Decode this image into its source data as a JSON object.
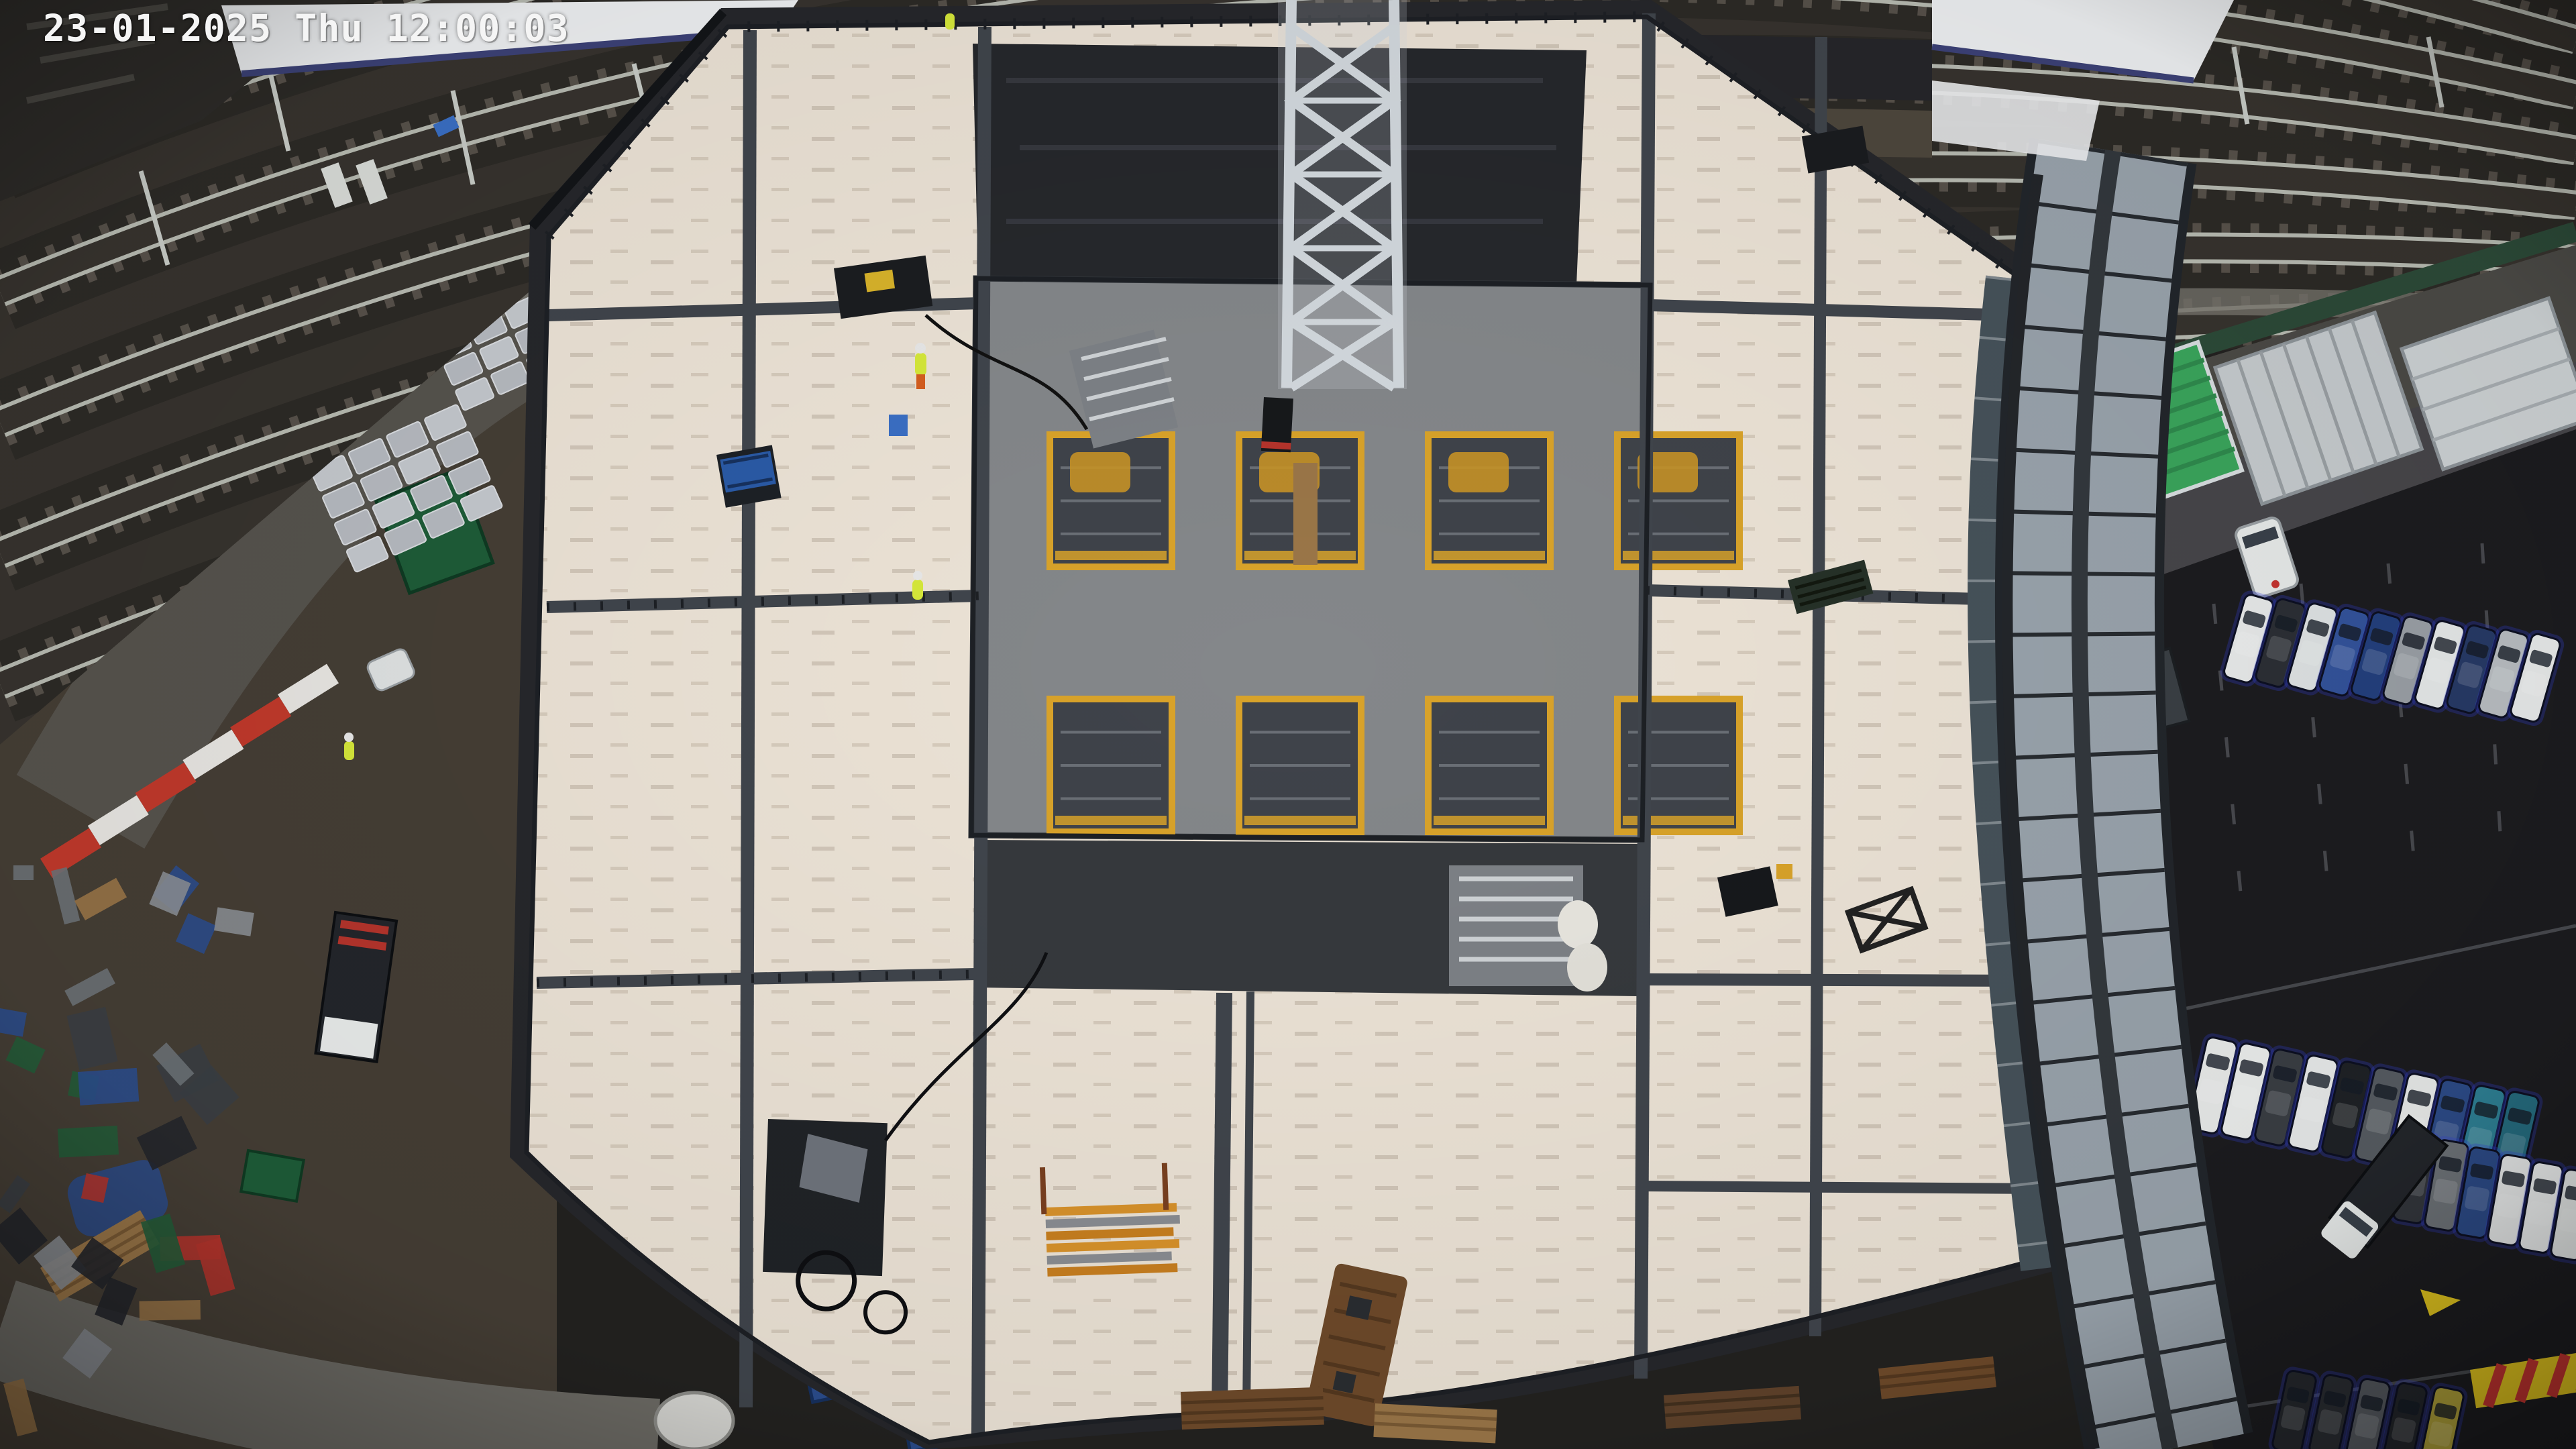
{
  "overlay": {
    "timestamp": "23-01-2025 Thu 12:00:03",
    "date": "23-01-2025",
    "day": "Thu",
    "time": "12:00:03"
  },
  "palette": {
    "osd_text": "#f5f5f5",
    "asphalt": "#232220",
    "ballast": "#37332e",
    "sleeper": "#57514a",
    "rail": "#b7bab1",
    "track_gap": "#2c2a26",
    "yard": "#453e35",
    "road": "#56534d",
    "path_light": "#6e6c66",
    "deck": "#ece3d6",
    "deck_shadow": "#d9cfc0",
    "steel": "#40454c",
    "mesh": "#1d2025",
    "scaffold_dark": "#26272b",
    "core": "#84878a",
    "core_void": "#3f434a",
    "formwork": "#d9a32a",
    "crane": "#d3d9de",
    "canopy": "#eef0f2",
    "canopy_edge": "#3c4277",
    "glazing": "#99a3ac",
    "glazing_frame": "#22262b",
    "fence_green": "#2c4a38",
    "grass": "#3c3b2c",
    "parking": "#1c1c1f",
    "container_green_roof": "#3aa55c",
    "container_white": "#c6cbce",
    "cabin_green": "#1e5c38",
    "container_blue": "#2b4c8c",
    "barrier_red": "#c0392b",
    "barrier_white": "#e8e6e2",
    "hoarding_yellow": "#e2c51e",
    "machine_blue": "#2a5aa6",
    "hivis": "#d6e83a",
    "timber": "#6e4a2a",
    "timber_light": "#9a7648",
    "van_white": "#e7eae9",
    "glow_blue": "#3340d4"
  },
  "railway": {
    "track_count": 7
  },
  "building": {
    "core": {
      "rows": 2,
      "columns": 4
    }
  },
  "parking": {
    "row_top": [
      "#e8eaea",
      "#2c2f35",
      "#dfe3e4",
      "#33539b",
      "#24407e",
      "#9aa0a6",
      "#e6e9e9",
      "#273a66",
      "#b9bec2",
      "#e8eaea"
    ],
    "row_middle": [
      "#e9ebea",
      "#eceeed",
      "#3a3e44",
      "#e8eaea",
      "#1f2226",
      "#565b61",
      "#e7e9e8",
      "#2c4a86",
      "#2e7f93",
      "#256b7e"
    ],
    "row_lower_right": [
      "#33363c",
      "#6d7277",
      "#2c4a86",
      "#e8eaea",
      "#eceeee",
      "#e4e7e6",
      "#3a5fa8",
      "#c43430"
    ],
    "row_bottom_edge": [
      "#26292e",
      "#2b2e33",
      "#565a60",
      "#23262b",
      "#b0a13a"
    ]
  },
  "yard": {
    "pallet_clusters": [
      {
        "cols": 4,
        "rows": 4
      },
      {
        "cols": 4,
        "rows": 4
      }
    ]
  }
}
